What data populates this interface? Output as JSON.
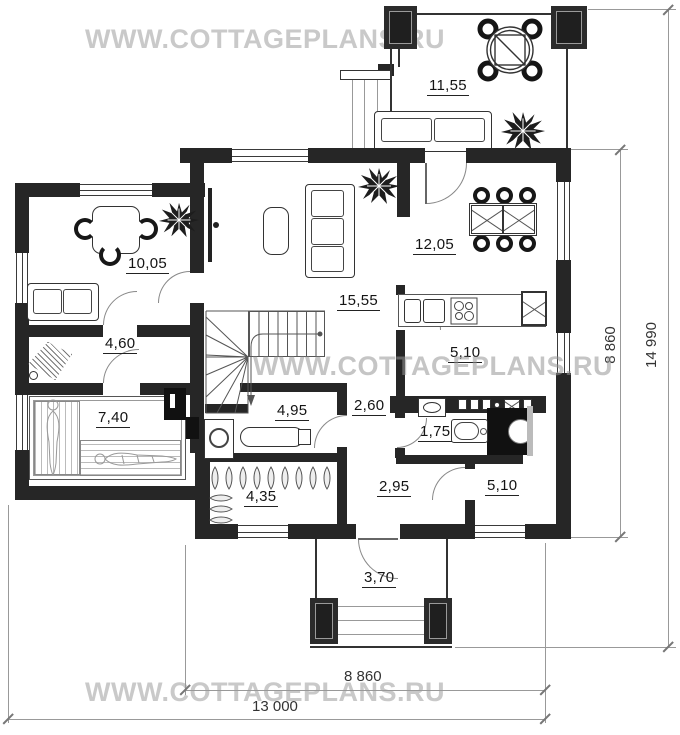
{
  "watermark": {
    "text": "WWW.COTTAGEPLANS.RU"
  },
  "rooms": {
    "terrace": {
      "label": "11,55"
    },
    "room_top_left": {
      "label": "10,05"
    },
    "dining": {
      "label": "12,05"
    },
    "living": {
      "label": "15,55"
    },
    "hall_small": {
      "label": "4,60"
    },
    "kitchen": {
      "label": "5,10"
    },
    "sauna": {
      "label": "7,40"
    },
    "laundry": {
      "label": "4,95"
    },
    "corridor": {
      "label": "2,60"
    },
    "bathroom": {
      "label": "1,75"
    },
    "wardrobe": {
      "label": "4,35"
    },
    "hall": {
      "label": "2,95"
    },
    "room_bottom_right": {
      "label": "5,10"
    },
    "porch": {
      "label": "3,70"
    }
  },
  "dimensions": {
    "house_width_inner": "8 860",
    "house_width_outer": "13 000",
    "house_height_inner": "8 860",
    "house_height_outer": "14 990"
  },
  "colors": {
    "wall": "#262626",
    "watermark": "#c9c9c9",
    "line": "#555"
  }
}
